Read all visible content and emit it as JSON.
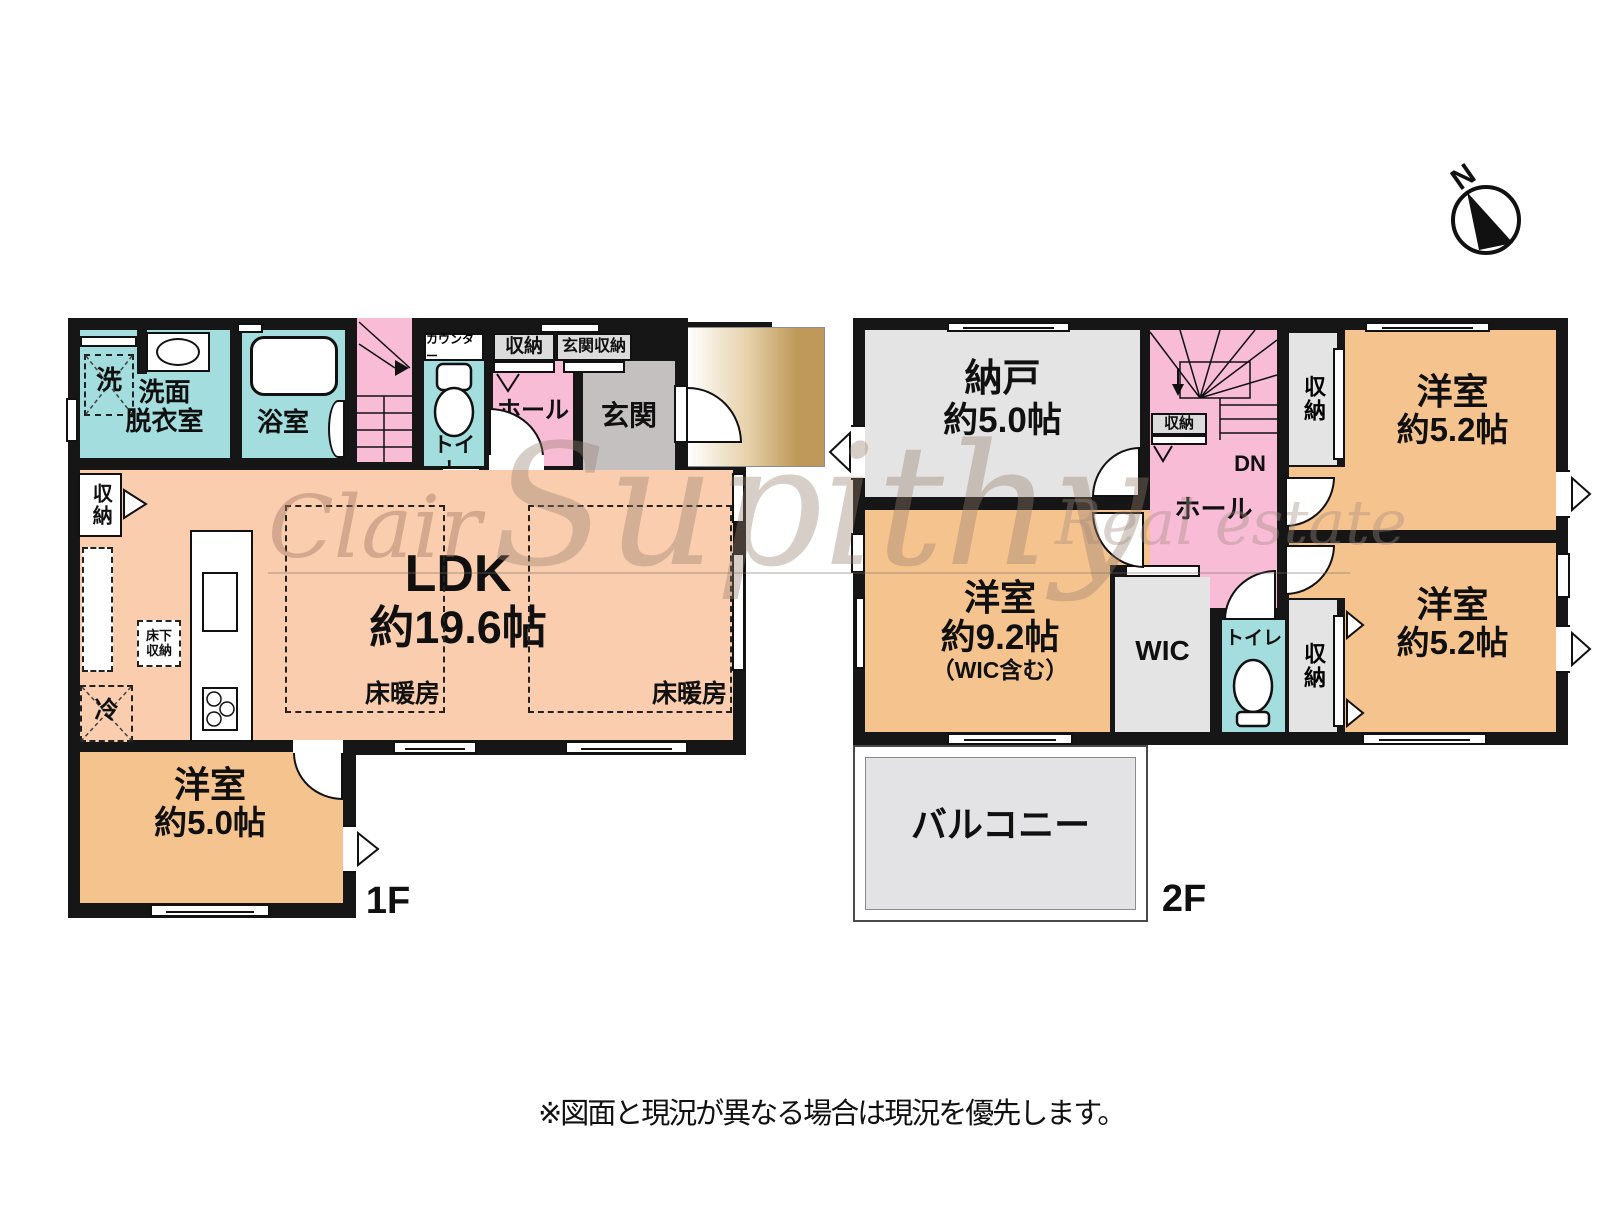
{
  "compass": {
    "north": "N"
  },
  "watermark": {
    "left": "Clair",
    "center": "Supithy",
    "right": "Real estate"
  },
  "footnote": "※図面と現況が異なる場合は現況を優先します。",
  "colors": {
    "ldk_peach": "#F9CDAE",
    "western_room_orange": "#F5C38E",
    "wet_area_teal": "#A3DDDE",
    "stair_hall_pink": "#F8BCD6",
    "storage_gray": "#E4E4E4",
    "entrance_gray": "#C4C0C0",
    "porch_tan": "#BE9959",
    "balcony_gray": "#E3E3E5",
    "wall_black": "#161616"
  },
  "floor1": {
    "label": "1F",
    "laundry": "洗",
    "washroom_l1": "洗面",
    "washroom_l2": "脱衣室",
    "bath": "浴室",
    "stairs_up": "UP",
    "counter": "カウンター",
    "toilet": "トイレ",
    "hall_storage": "収納",
    "entrance_storage": "玄関収納",
    "hall": "ホール",
    "entrance": "玄関",
    "wall_closet": "収納",
    "ldk_l1": "LDK",
    "ldk_l2": "約19.6帖",
    "floor_heating": "床暖房",
    "underfloor_l1": "床下",
    "underfloor_l2": "収納",
    "fridge": "冷",
    "room_l1": "洋室",
    "room_l2": "約5.0帖"
  },
  "floor2": {
    "label": "2F",
    "storeroom_l1": "納戸",
    "storeroom_l2": "約5.0帖",
    "stair_storage": "収納",
    "stairs_down": "DN",
    "hall": "ホール",
    "closet_top": "収納",
    "room_tr_l1": "洋室",
    "room_tr_l2": "約5.2帖",
    "room_br_l1": "洋室",
    "room_br_l2": "約5.2帖",
    "closet_bottom": "収納",
    "wic": "WIC",
    "toilet": "トイレ",
    "room_left_l1": "洋室",
    "room_left_l2": "約9.2帖",
    "room_left_l3": "（WIC含む）",
    "balcony": "バルコニー"
  }
}
